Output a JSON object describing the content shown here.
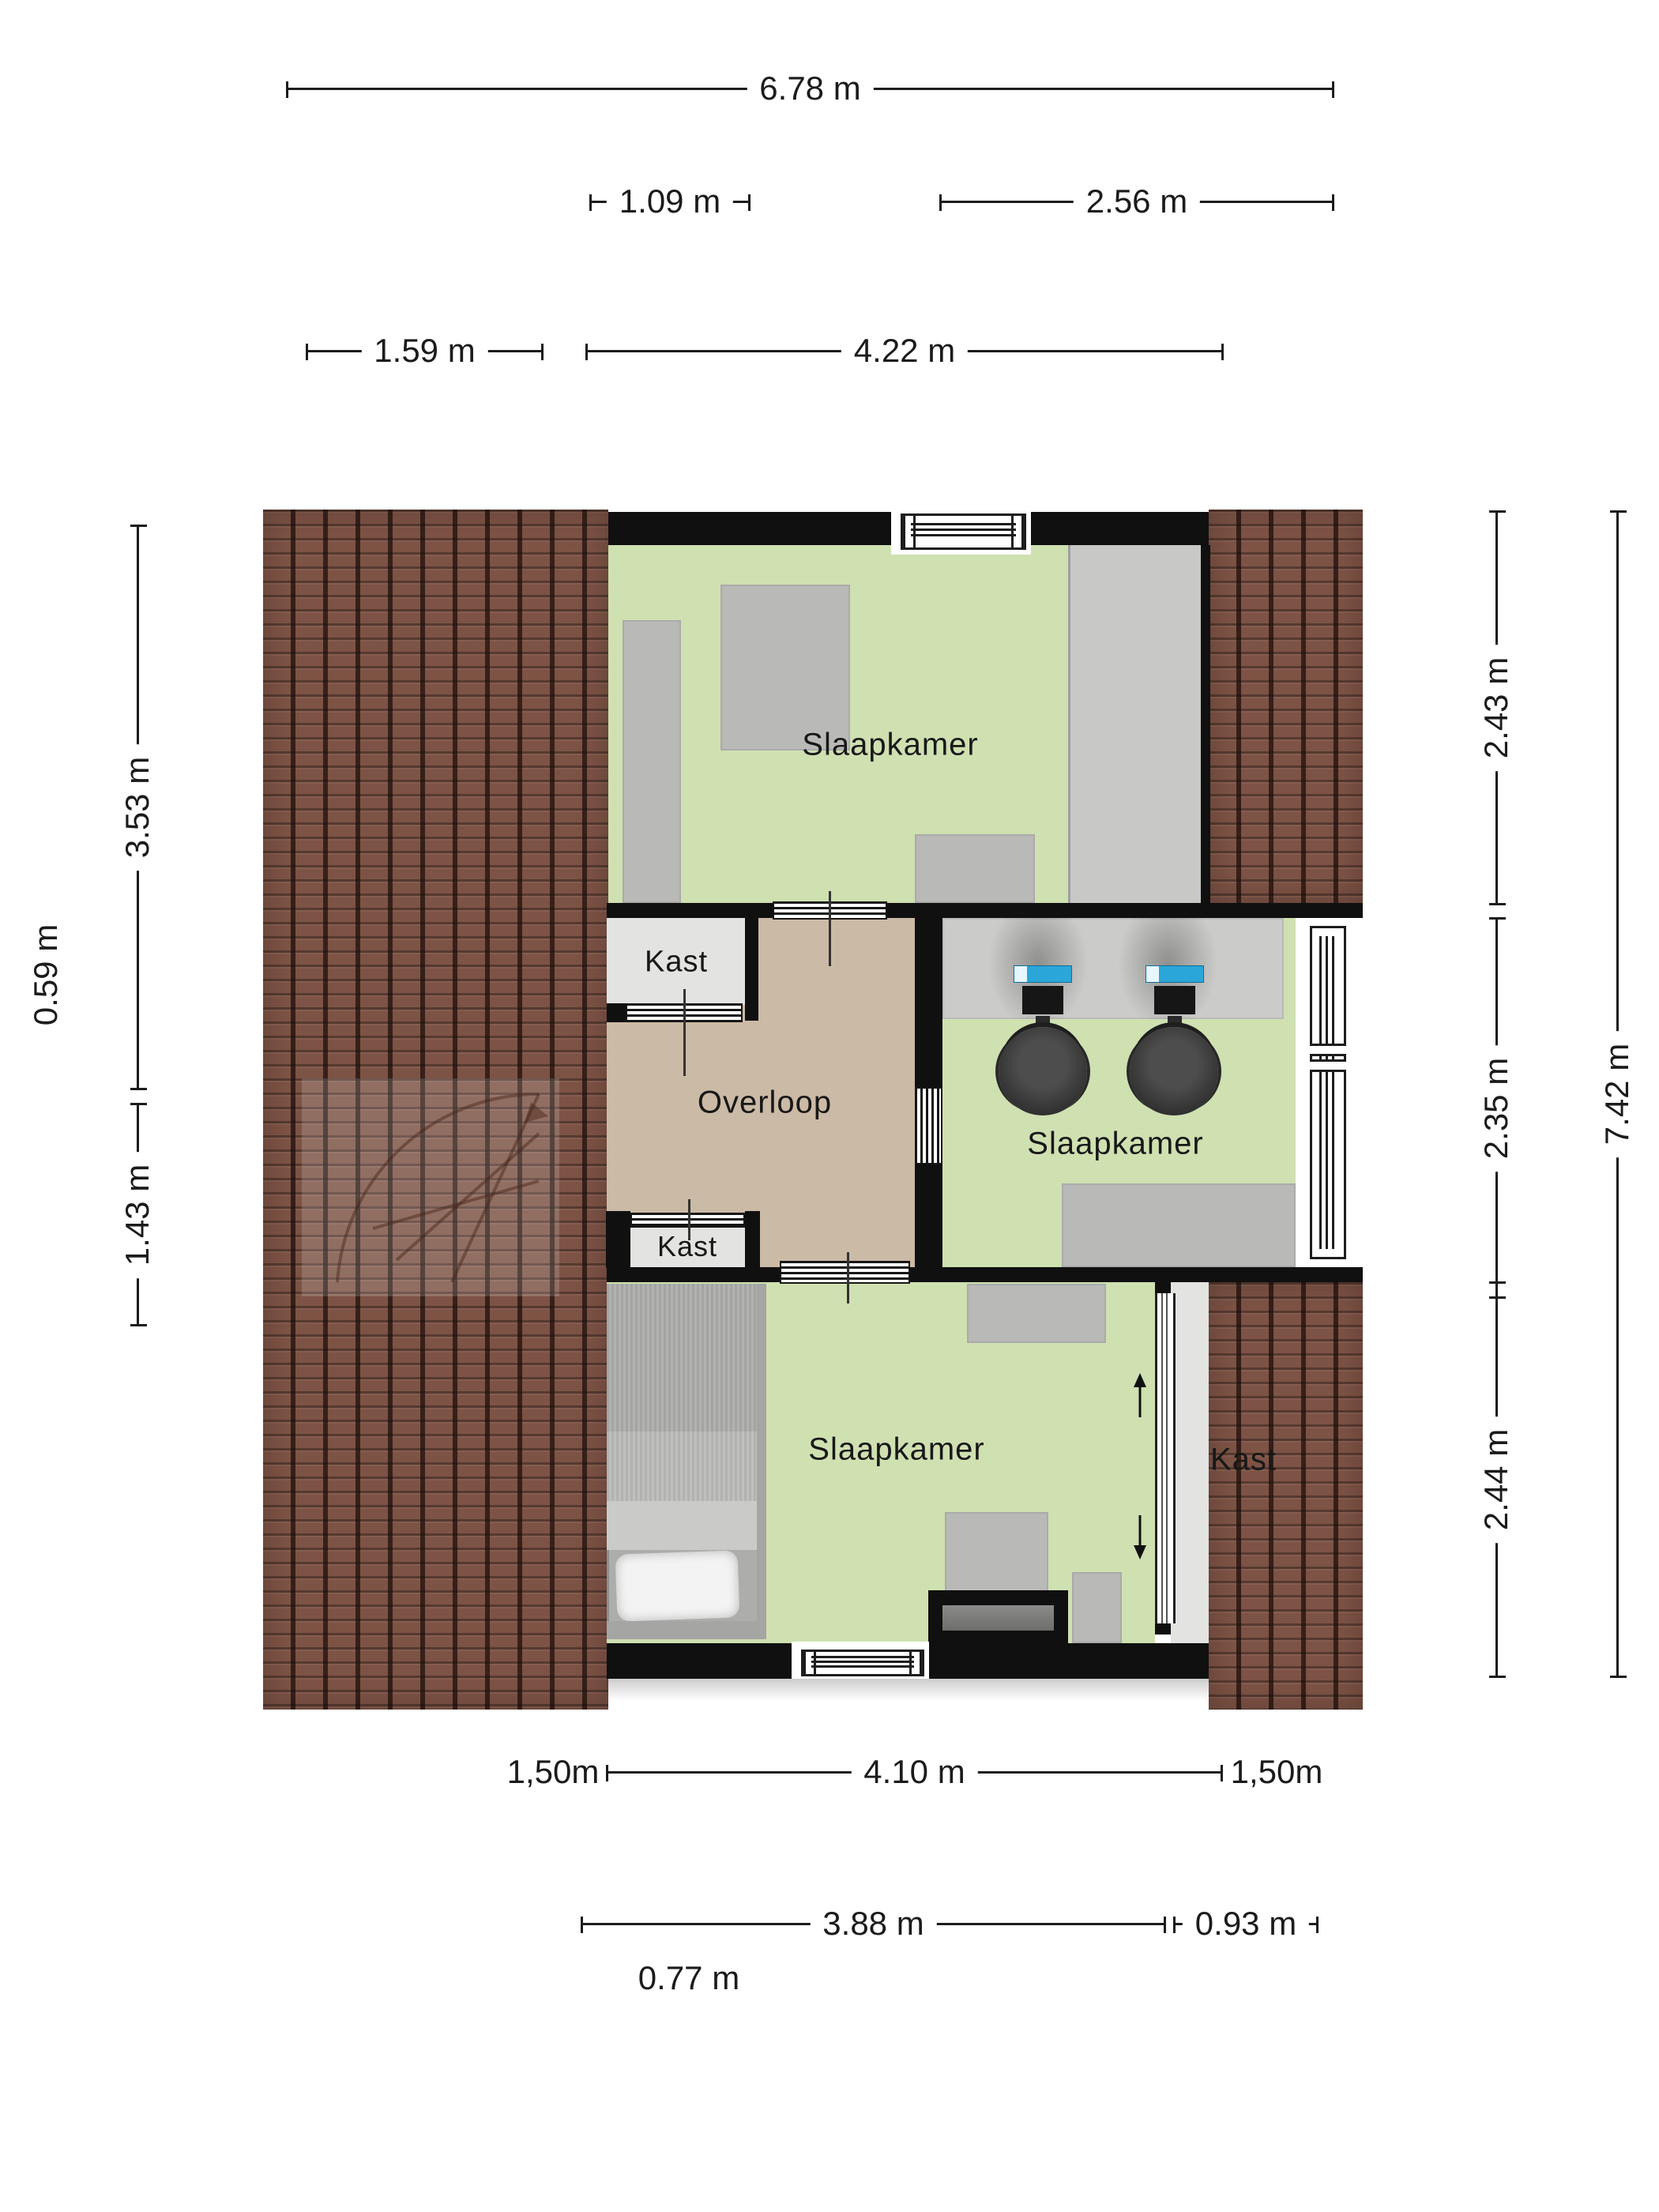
{
  "dims": {
    "total_width": "6.78 m",
    "closet_width": "1.09 m",
    "bedroom_mid_width": "2.56 m",
    "roof_left_width": "1.59 m",
    "bedroom_top_width": "4.22 m",
    "roof_top_height": "3.53 m",
    "eave_height": "0.59 m",
    "roof_bottom_height": "1.43 m",
    "bedroom_top_height": "2.43 m",
    "bedroom_mid_height": "2.35 m",
    "total_height": "7.42 m",
    "bedroom_bottom_height": "2.44 m",
    "eave_left_bottom": "1,50m",
    "bedroom_bottom_width": "4.10 m",
    "eave_right_bottom": "1,50m",
    "window_offset_bottom": "3.88 m",
    "window_width_bottom": "0.93 m",
    "door_offset_bottom": "0.77 m"
  },
  "rooms": {
    "bedroom_top": "Slaapkamer",
    "bedroom_mid": "Slaapkamer",
    "bedroom_bottom": "Slaapkamer",
    "hall": "Overloop",
    "closet_top": "Kast",
    "closet_mid": "Kast",
    "closet_bottom": "Kast"
  },
  "colors": {
    "wall": "#101010",
    "green": "#cfe0b1",
    "tan": "#cbbaa5",
    "closet-floor": "#e3e3e1",
    "grayzone": "#c8c8c6",
    "furniture": "#b9b9b7",
    "roof-base": "#7d5345",
    "desk": "#cbcbc9",
    "screen": "#2ba6d9"
  }
}
